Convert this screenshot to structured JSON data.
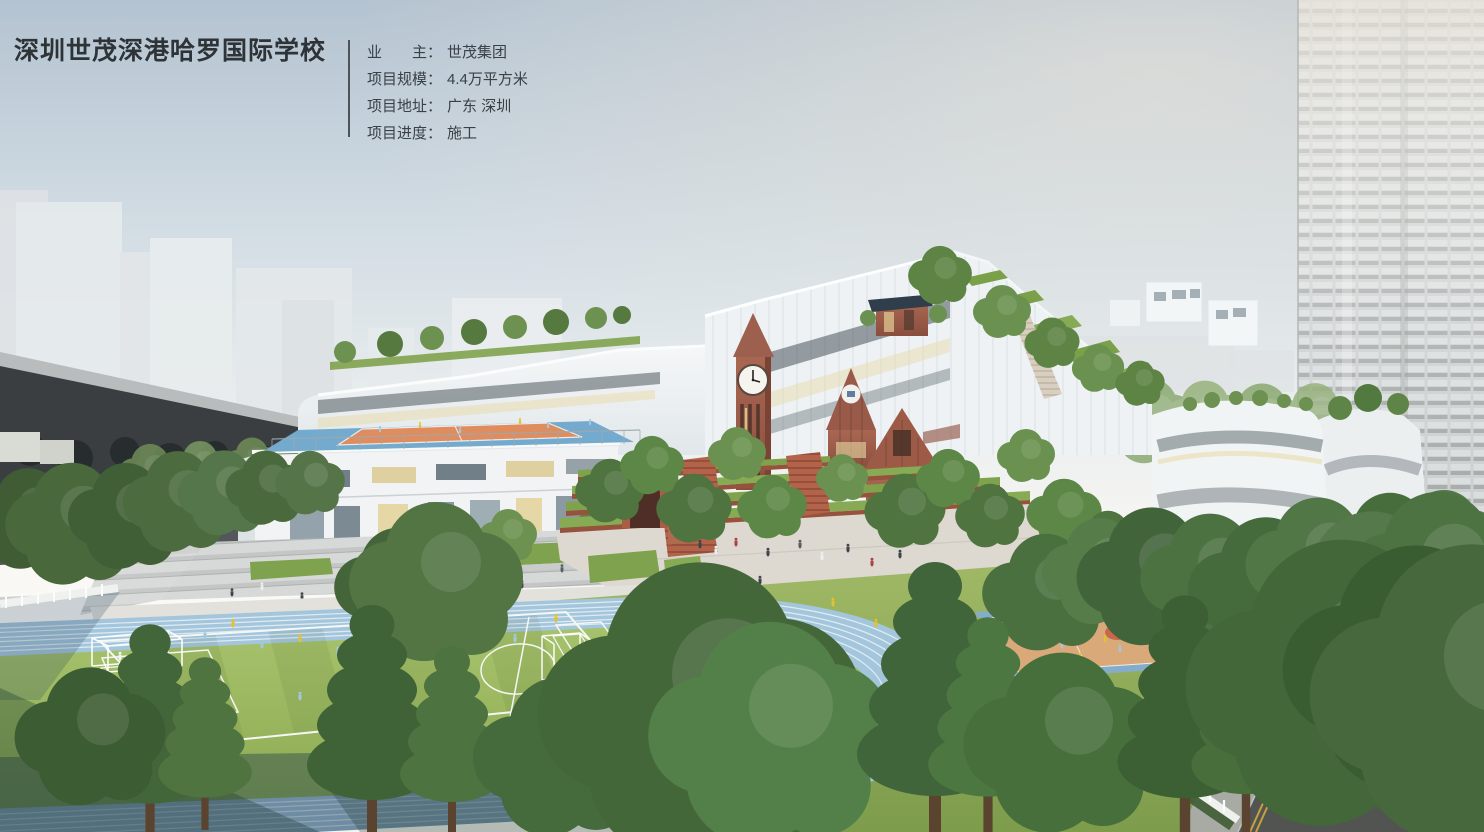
{
  "header": {
    "title": "深圳世茂深港哈罗国际学校",
    "info": [
      {
        "label": "业　　主：",
        "value": "世茂集团"
      },
      {
        "label": "项目规模：",
        "value": "4.4万平方米"
      },
      {
        "label": "项目地址：",
        "value": "广东 深圳"
      },
      {
        "label": "项目进度：",
        "value": "施工"
      }
    ]
  },
  "scene": {
    "type": "architectural-aerial-rendering",
    "palette": {
      "sky_top": "#b4c3d1",
      "track_blue": "#a4c6dc",
      "field_green": "#9cbb64",
      "brick_red": "#9c5a45",
      "court_tan": "#d9a97a",
      "court_key_orange": "#c8684a",
      "rooftop_court_blue": "#74aace",
      "rooftop_court_orange": "#df8c5e",
      "jersey_yellow": "#e3c22f",
      "jersey_blue": "#a3c8de",
      "tree_green": "#4c7340",
      "road_asphalt": "#515451",
      "fence_white": "#eef1ee"
    }
  }
}
